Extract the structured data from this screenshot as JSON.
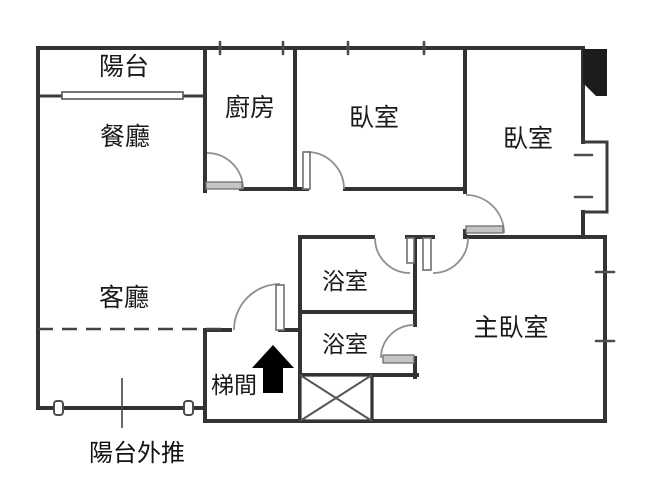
{
  "rooms": {
    "balcony": "陽台",
    "dining": "餐廳",
    "kitchen": "廚房",
    "bedroom_top": "臥室",
    "bedroom_right": "臥室",
    "living": "客廳",
    "bathroom_upper": "浴室",
    "bathroom_lower": "浴室",
    "master_bedroom": "主臥室",
    "stairwell": "梯間"
  },
  "annotations": {
    "balcony_extension": "陽台外推"
  },
  "icons": {
    "stairs_direction": "up-arrow",
    "elevator_shaft": "crossed-box",
    "structural_column": "filled-black-block"
  },
  "colors": {
    "wall": "#333333",
    "background": "#ffffff",
    "door_arc": "#8f8f8f",
    "threshold": "#c4c4c4",
    "dashed_line": "#444444",
    "arrow": "#000000"
  }
}
